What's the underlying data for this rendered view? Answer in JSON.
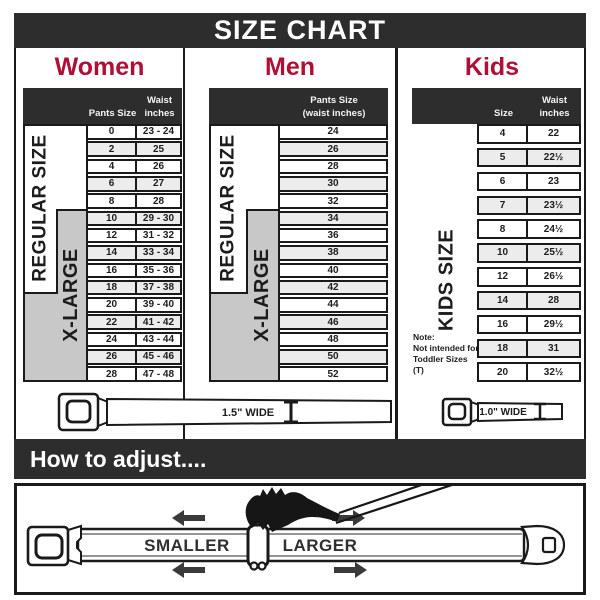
{
  "title": "SIZE CHART",
  "colors": {
    "accent": "#b00f35",
    "dark_bar": "#2d2d2d",
    "xlarge_gray": "#c8c8c8",
    "alt_row": "#ececec"
  },
  "sections": {
    "women": {
      "label": "Women",
      "header": {
        "col1": "Pants Size",
        "col2_line1": "Waist",
        "col2_line2": "inches"
      },
      "regular_label": "REGULAR SIZE",
      "xlarge_label": "X-LARGE",
      "rows": [
        {
          "size": "0",
          "waist": "23 - 24"
        },
        {
          "size": "2",
          "waist": "25"
        },
        {
          "size": "4",
          "waist": "26"
        },
        {
          "size": "6",
          "waist": "27"
        },
        {
          "size": "8",
          "waist": "28"
        },
        {
          "size": "10",
          "waist": "29 - 30"
        },
        {
          "size": "12",
          "waist": "31 - 32"
        },
        {
          "size": "14",
          "waist": "33 - 34"
        },
        {
          "size": "16",
          "waist": "35 - 36"
        },
        {
          "size": "18",
          "waist": "37 - 38"
        },
        {
          "size": "20",
          "waist": "39 - 40"
        },
        {
          "size": "22",
          "waist": "41 - 42"
        },
        {
          "size": "24",
          "waist": "43 - 44"
        },
        {
          "size": "26",
          "waist": "45 - 46"
        },
        {
          "size": "28",
          "waist": "47 - 48"
        }
      ],
      "belt_width_label": "1.5\" WIDE"
    },
    "men": {
      "label": "Men",
      "header": {
        "col1_line1": "Pants Size",
        "col1_line2": "(waist inches)"
      },
      "regular_label": "REGULAR SIZE",
      "xlarge_label": "X-LARGE",
      "rows": [
        {
          "size": "24"
        },
        {
          "size": "26"
        },
        {
          "size": "28"
        },
        {
          "size": "30"
        },
        {
          "size": "32"
        },
        {
          "size": "34"
        },
        {
          "size": "36"
        },
        {
          "size": "38"
        },
        {
          "size": "40"
        },
        {
          "size": "42"
        },
        {
          "size": "44"
        },
        {
          "size": "46"
        },
        {
          "size": "48"
        },
        {
          "size": "50"
        },
        {
          "size": "52"
        }
      ]
    },
    "kids": {
      "label": "Kids",
      "header": {
        "col1": "Size",
        "col2_line1": "Waist",
        "col2_line2": "inches"
      },
      "kids_size_label": "KIDS SIZE",
      "note_line1": "Note:",
      "note_line2": "Not intended for",
      "note_line3": "Toddler Sizes (T)",
      "rows": [
        {
          "size": "4",
          "waist": "22"
        },
        {
          "size": "5",
          "waist": "22½"
        },
        {
          "size": "6",
          "waist": "23"
        },
        {
          "size": "7",
          "waist": "23½"
        },
        {
          "size": "8",
          "waist": "24½"
        },
        {
          "size": "10",
          "waist": "25½"
        },
        {
          "size": "12",
          "waist": "26½"
        },
        {
          "size": "14",
          "waist": "28"
        },
        {
          "size": "16",
          "waist": "29½"
        },
        {
          "size": "18",
          "waist": "31"
        },
        {
          "size": "20",
          "waist": "32½"
        }
      ],
      "belt_width_label": "1.0\" WIDE"
    }
  },
  "how_to_adjust": {
    "title": "How to adjust....",
    "smaller": "SMALLER",
    "larger": "LARGER"
  }
}
